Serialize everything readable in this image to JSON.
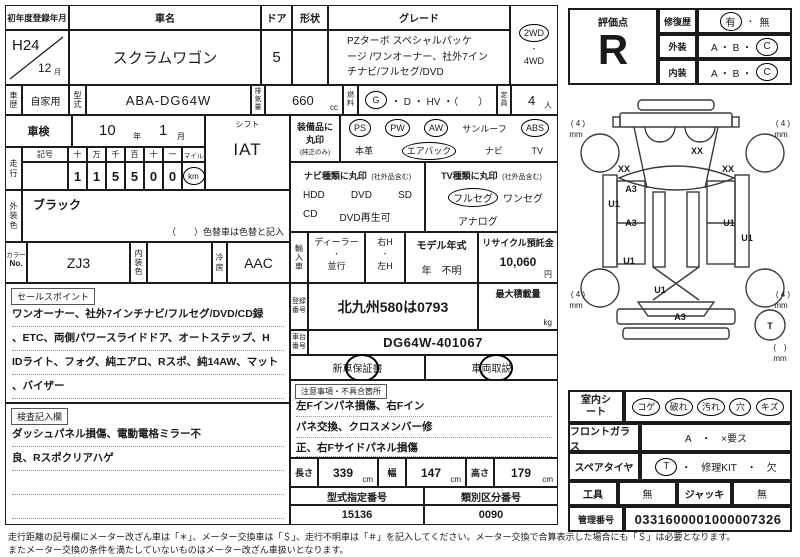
{
  "doc": {
    "first_reg": {
      "label": "初年度登録年月",
      "year": "H24",
      "month": "12",
      "month_unit": "月"
    },
    "car_name": {
      "label": "車名",
      "value": "スクラムワゴン"
    },
    "doors": {
      "label": "ドア",
      "value": "5"
    },
    "shape": {
      "label": "形状",
      "value": ""
    },
    "grade": {
      "label": "グレード",
      "line1": "PZターボ スペシャルパッケ",
      "line2": "ージ /ワンオーナー、社外7イン",
      "line3": "チナビ/フルセグ/DVD"
    },
    "drive": {
      "wd2": "2WD",
      "dot": "・",
      "wd4": "4WD"
    },
    "history": {
      "label": "車歴",
      "value": "自家用"
    },
    "model_code": {
      "label": "型式",
      "value": "ABA-DG64W"
    },
    "displacement": {
      "label": "排気量",
      "value": "660",
      "unit": "cc"
    },
    "fuel": {
      "label": "燃料",
      "g": "G",
      "rest": "・ D ・ HV ・（　　）"
    },
    "capacity": {
      "label": "定員",
      "value": "4",
      "unit": "人"
    },
    "inspection": {
      "label": "車検",
      "year": "10",
      "year_unit": "年",
      "month": "1",
      "month_unit": "月"
    },
    "shift": {
      "label": "シフト",
      "value": "IAT"
    },
    "mileage": {
      "label": "走行",
      "sign": "記号",
      "h1": "十",
      "h2": "万",
      "h3": "千",
      "h4": "百",
      "h5": "十",
      "h6": "一",
      "d1": "1",
      "d2": "1",
      "d3": "5",
      "d4": "5",
      "d5": "0",
      "d6": "0",
      "mile": "マイル",
      "km": "km"
    },
    "ext_color": {
      "label": "外装色",
      "value": "ブラック",
      "note": "（　　）色替車は色替と記入"
    },
    "color_no": {
      "label1": "カラー",
      "label2": "No.",
      "value": "ZJ3"
    },
    "int_color": {
      "label": "内装色",
      "value": ""
    },
    "ac": {
      "label": "冷房",
      "value": "AAC"
    },
    "sales": {
      "tag": "セールスポイント",
      "line1": "ワンオーナー、社外7インチナビ/フルセグ/DVD/CD録",
      "line2": "、ETC、両側パワースライドドア、オートステップ、H",
      "line3": "IDライト、フォグ、純エアロ、Rスポ、純14AW、マット",
      "line4": "、バイザー"
    },
    "inspector": {
      "tag": "検査記入欄",
      "line1": "ダッシュパネル損傷、電動電格ミラー不",
      "line2": "良、Rスポクリアハゲ"
    },
    "equipment": {
      "label1": "装備品に",
      "label2": "丸印",
      "label3": "(純正のみ)",
      "ps": "PS",
      "pw": "PW",
      "aw": "AW",
      "sunroof": "サンルーフ",
      "abs": "ABS",
      "leather": "本革",
      "airbag": "エアバック",
      "navi": "ナビ",
      "tv": "TV"
    },
    "navi_type": {
      "header": "ナビ種類に丸印",
      "header_sub": "(社外品含む)",
      "hdd": "HDD",
      "dvd": "DVD",
      "sd": "SD",
      "cd": "CD",
      "dvd_play": "DVD再生可"
    },
    "tv_type": {
      "header": "TV種類に丸印",
      "header_sub": "(社外品含む)",
      "full": "フルセグ",
      "one": "ワンセグ",
      "analog": "アナログ"
    },
    "import": {
      "label": "輸入車",
      "dealer": "ディーラー",
      "dot": "・",
      "parallel": "並行",
      "rh": "右H",
      "lh": "左H",
      "model_year_label": "モデル年式",
      "model_year": "年　不明",
      "recycle_label": "リサイクル預託金",
      "recycle": "10,060",
      "recycle_unit": "円"
    },
    "reg_no": {
      "label": "登録番号",
      "value": "北九州580は0793"
    },
    "max_load": {
      "label": "最大積載量",
      "unit": "kg"
    },
    "chassis": {
      "label": "車台番号",
      "value": "DG64W-401067"
    },
    "docs": {
      "warranty": "新車保証書",
      "manual": "車両取説"
    },
    "caution": {
      "tag": "注意事項・不具合箇所",
      "line1": "左Fインパネ損傷、右Fイン",
      "line2": "パネ交換、クロスメンバー修",
      "line3": "正、右Fサイドパネル損傷"
    },
    "dims": {
      "length_label": "長さ",
      "length": "339",
      "width_label": "幅",
      "width": "147",
      "height_label": "高さ",
      "height": "179",
      "unit": "cm"
    },
    "type_no": {
      "label": "型式指定番号",
      "value": "15136"
    },
    "class_no": {
      "label": "類別区分番号",
      "value": "0090"
    },
    "evaluation": {
      "label": "評価点",
      "score": "R",
      "repair_label": "修復歴",
      "yes": "有",
      "dot": "・",
      "no": "無",
      "ext_label": "外装",
      "int_label": "内装",
      "ab": "A ・ B ・",
      "c": "C"
    },
    "interior": {
      "label": "室内シート",
      "i1": "コゲ",
      "i2": "破れ",
      "i3": "汚れ",
      "i4": "穴",
      "i5": "キズ"
    },
    "glass": {
      "label": "フロントガラス",
      "value": "A　・　×要ス"
    },
    "spare": {
      "label": "スペアタイヤ",
      "t": "T",
      "rest": "・　修理KIT　・　欠"
    },
    "tools": {
      "label": "工具",
      "value": "無",
      "jack_label": "ジャッキ",
      "jack_value": "無"
    },
    "admin": {
      "label": "管理番号",
      "value": "0331600001000007326"
    },
    "diagram": {
      "t4": "( 4 )",
      "mm": "mm",
      "xx": "XX",
      "a3": "A3",
      "u1": "U1",
      "spare_t": "T",
      "empty_bracket": "(　)"
    },
    "footer": {
      "line1": "走行距離の記号欄にメーター改ざん車は「＊」、メーター交換車は「＄」、走行不明車は「＃」を記入してください。メーター交換で合算表示した場合にも「＄」は必要となります。",
      "line2": "またメーター交換の条件を満たしていないものはメーター改ざん車扱いとなります。"
    }
  }
}
